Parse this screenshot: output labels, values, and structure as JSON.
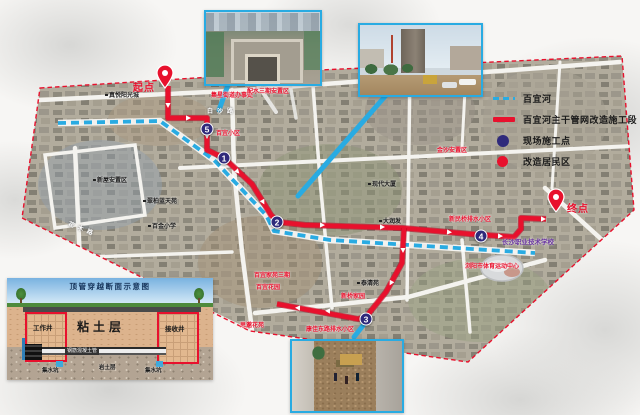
{
  "legend": {
    "items": [
      {
        "name": "river",
        "label": "百宜河",
        "swatch": "dashed-line",
        "color": "#29abe2"
      },
      {
        "name": "construction-segment",
        "label": "百宜河主干管网改造施工段",
        "swatch": "solid-line",
        "color": "#e8112d"
      },
      {
        "name": "site-point",
        "label": "现场施工点",
        "swatch": "dot",
        "color": "#2f2a7b"
      },
      {
        "name": "renovated-area",
        "label": "改造居民区",
        "swatch": "dot",
        "color": "#e8112d"
      }
    ]
  },
  "map": {
    "start_label": "起点",
    "end_label": "终点",
    "points": [
      {
        "num": "1",
        "x": 224,
        "y": 158
      },
      {
        "num": "2",
        "x": 277,
        "y": 222
      },
      {
        "num": "3",
        "x": 366,
        "y": 319
      },
      {
        "num": "4",
        "x": 481,
        "y": 236
      },
      {
        "num": "5",
        "x": 207,
        "y": 129
      }
    ],
    "labels": [
      {
        "text": "集星街道办事处",
        "x": 232,
        "y": 96,
        "cls": "red"
      },
      {
        "text": "配水三期安置区",
        "x": 268,
        "y": 92,
        "cls": "red"
      },
      {
        "text": "百宜小区",
        "x": 228,
        "y": 134,
        "cls": "red"
      },
      {
        "text": "金沙安置区",
        "x": 452,
        "y": 151,
        "cls": "red"
      },
      {
        "text": "新民桥排水小区",
        "x": 470,
        "y": 220,
        "cls": "red"
      },
      {
        "text": "百宜家苑三期",
        "x": 272,
        "y": 276,
        "cls": "red"
      },
      {
        "text": "百宜花园",
        "x": 268,
        "y": 288,
        "cls": "red"
      },
      {
        "text": "新桥家园",
        "x": 353,
        "y": 297,
        "cls": "red"
      },
      {
        "text": "思邈花苑",
        "x": 252,
        "y": 326,
        "cls": "red"
      },
      {
        "text": "康佳东路排水小区",
        "x": 330,
        "y": 330,
        "cls": "red"
      },
      {
        "text": "浏阳市体育运动中心",
        "x": 492,
        "y": 267,
        "cls": "red"
      },
      {
        "text": "真悦阳光城",
        "x": 122,
        "y": 96,
        "cls": "black"
      },
      {
        "text": "新屋安置区",
        "x": 110,
        "y": 181,
        "cls": "black"
      },
      {
        "text": "翠柏蓝天苑",
        "x": 160,
        "y": 202,
        "cls": "black"
      },
      {
        "text": "百金小学",
        "x": 162,
        "y": 227,
        "cls": "black"
      },
      {
        "text": "现代大厦",
        "x": 382,
        "y": 185,
        "cls": "black"
      },
      {
        "text": "大润发",
        "x": 390,
        "y": 222,
        "cls": "black"
      },
      {
        "text": "泰清苑",
        "x": 368,
        "y": 284,
        "cls": "black"
      },
      {
        "text": "长沙职业技术学校",
        "x": 528,
        "y": 243,
        "cls": "purple"
      },
      {
        "text": "白沙路",
        "x": 222,
        "y": 112,
        "cls": "road"
      },
      {
        "text": "花木路",
        "x": 82,
        "y": 230,
        "cls": "road",
        "rot": 22
      }
    ]
  },
  "cross_section": {
    "title": "顶管穿越断面示意图",
    "clay_layer": "粘土层",
    "working_shaft": "工作井",
    "receiving_shaft": "接收井",
    "pipe_label": "钢筋混凝土管",
    "sump_left": "集水坑",
    "rock_layer": "岩土层",
    "sump_right": "集水坑"
  }
}
